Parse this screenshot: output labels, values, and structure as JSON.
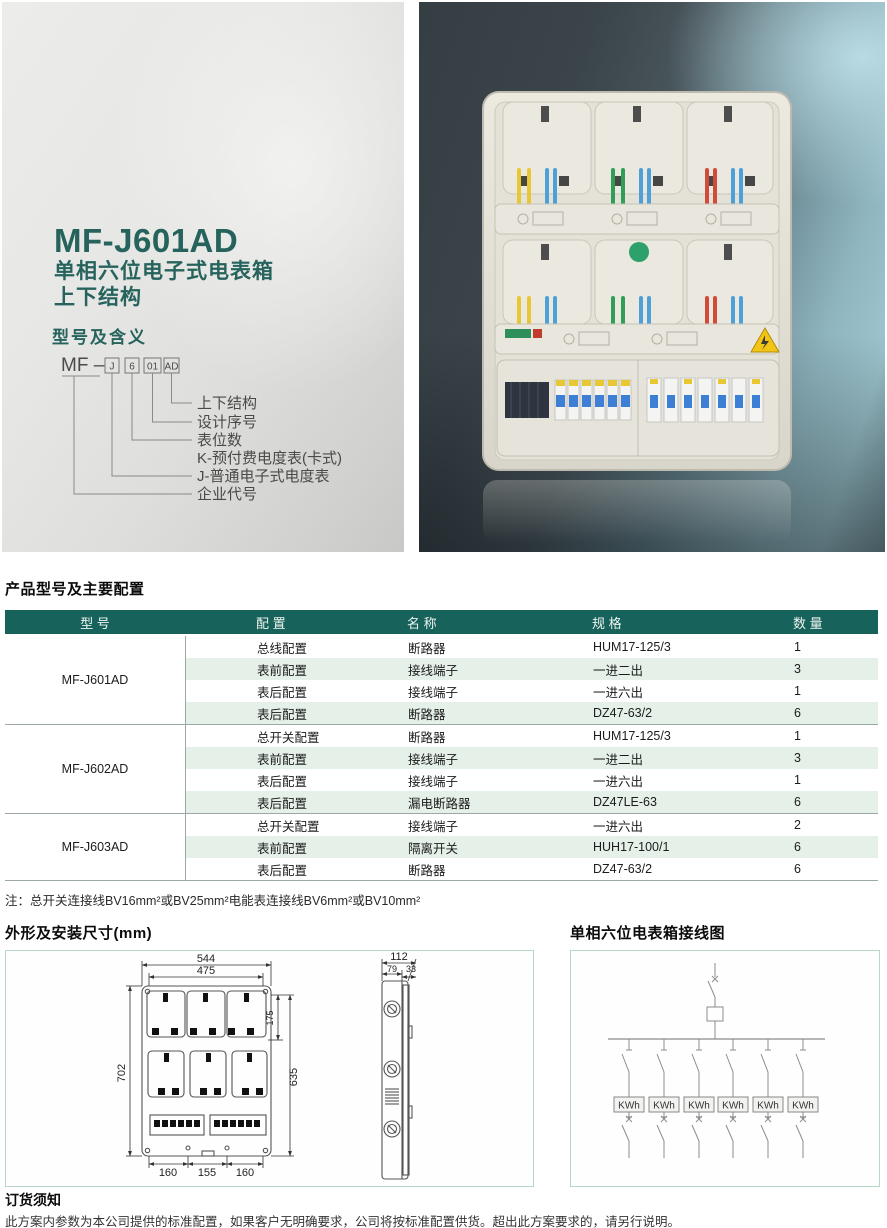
{
  "colors": {
    "accent_teal": "#17625a",
    "title_teal": "#26635d",
    "row_green": "#e4f0e8",
    "box_border": "#b7d8c5"
  },
  "intro": {
    "model": "MF-J601AD",
    "subtitle1": "单相六位电子式电表箱",
    "subtitle2": "上下结构",
    "section_title": "型号及含义",
    "diagram": {
      "prefix": "MF –",
      "segments": [
        "J",
        "6",
        "01",
        "AD"
      ],
      "meanings": [
        "上下结构",
        "设计序号",
        "表位数",
        "K-预付费电度表(卡式)",
        "J-普通电子式电度表",
        "企业代号"
      ]
    }
  },
  "config_section": {
    "title": "产品型号及主要配置",
    "table": {
      "headers": [
        "型 号",
        "配 置",
        "名 称",
        "规 格",
        "数 量"
      ],
      "groups": [
        {
          "model": "MF-J601AD",
          "rows": [
            [
              "总线配置",
              "断路器",
              "HUM17-125/3",
              "1"
            ],
            [
              "表前配置",
              "接线端子",
              "一进二出",
              "3"
            ],
            [
              "表后配置",
              "接线端子",
              "一进六出",
              "1"
            ],
            [
              "表后配置",
              "断路器",
              "DZ47-63/2",
              "6"
            ]
          ]
        },
        {
          "model": "MF-J602AD",
          "rows": [
            [
              "总开关配置",
              "断路器",
              "HUM17-125/3",
              "1"
            ],
            [
              "表前配置",
              "接线端子",
              "一进二出",
              "3"
            ],
            [
              "表后配置",
              "接线端子",
              "一进六出",
              "1"
            ],
            [
              "表后配置",
              "漏电断路器",
              "DZ47LE-63",
              "6"
            ]
          ]
        },
        {
          "model": "MF-J603AD",
          "rows": [
            [
              "总开关配置",
              "接线端子",
              "一进六出",
              "2"
            ],
            [
              "表前配置",
              "隔离开关",
              "HUH17-100/1",
              "6"
            ],
            [
              "表后配置",
              "断路器",
              "DZ47-63/2",
              "6"
            ]
          ]
        }
      ]
    },
    "note": "注：总开关连接线BV16mm²或BV25mm²电能表连接线BV6mm²或BV10mm²"
  },
  "dimensions_section": {
    "title": "外形及安装尺寸(mm)",
    "front": {
      "overall_width": "544",
      "mount_width": "475",
      "overall_height": "702",
      "mount_height": "635",
      "top_offset": "175",
      "bottom_left": "160",
      "bottom_center": "155",
      "bottom_right": "160"
    },
    "side": {
      "depth": "112",
      "body_depth": "79",
      "cover_depth": "33"
    }
  },
  "wiring_section": {
    "title": "单相六位电表箱接线图",
    "kwh_label": "KWh",
    "meter_count": 6
  },
  "order_section": {
    "title": "订货须知",
    "text": "此方案内参数为本公司提供的标准配置，如果客户无明确要求，公司将按标准配置供货。超出此方案要求的，请另行说明。"
  }
}
